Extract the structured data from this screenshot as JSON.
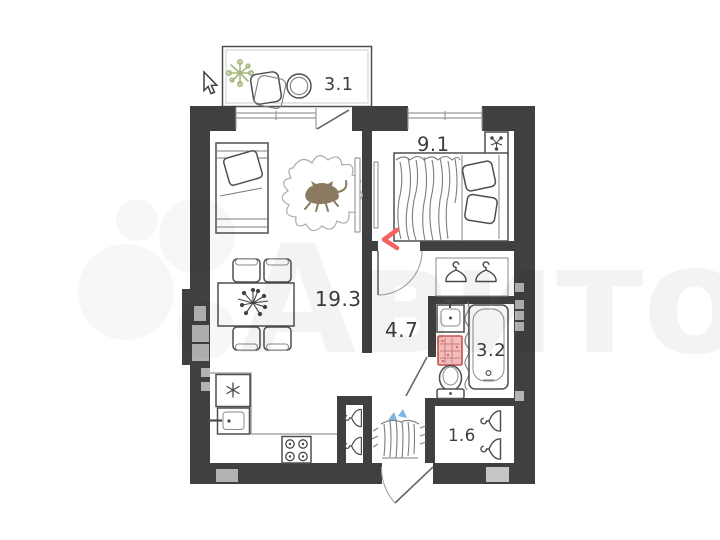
{
  "page": {
    "type": "apartment-floor-plan",
    "background": "#ffffff"
  },
  "watermark": {
    "brand": "Авито"
  },
  "rooms": {
    "balcony": {
      "name": "balcony",
      "label": "3.1"
    },
    "bedroom": {
      "name": "bedroom",
      "label": "9.1"
    },
    "living": {
      "name": "living-room-kitchen",
      "label": "19.3"
    },
    "hallway": {
      "name": "hallway",
      "label": "4.7"
    },
    "bathroom": {
      "name": "bathroom",
      "label": "3.2"
    },
    "entry": {
      "name": "entry-closet",
      "label": "1.6"
    }
  },
  "colors": {
    "wall": "#404040",
    "vent_gray": "#b3b3b3",
    "label_text": "#3c3c3c",
    "plant_green": "#a3b87c",
    "cat_brown": "#8b7a5f",
    "laundry_pink": "#f2bcbc",
    "laundry_red": "#c4524e",
    "accent_red": "#f2635f",
    "umbrella_blue": "#7fb5df",
    "watermark_gray": "#f2f2f2"
  },
  "icons": {
    "fridge": "snowflake-icon",
    "stove": "four-burners-icon",
    "closets": "clothes-hanger-icon",
    "balcony_plant": "plant-icon",
    "table_flowers": "bouquet-icon",
    "pet": "cat-icon",
    "pointer": "arrow-cursor-icon"
  }
}
